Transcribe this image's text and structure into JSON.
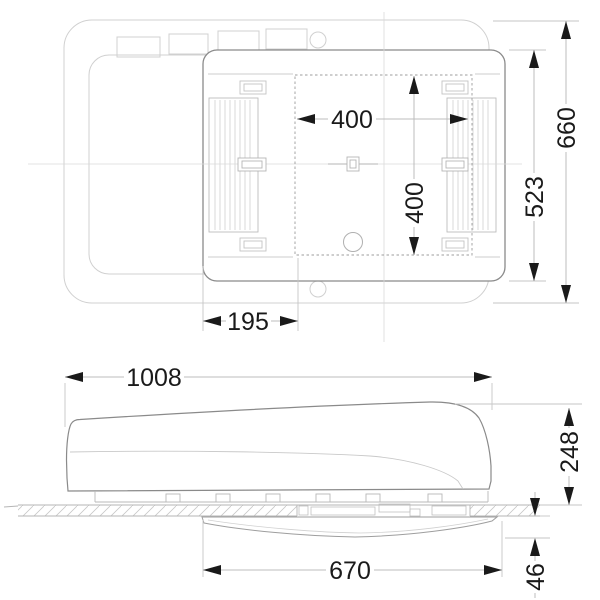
{
  "dimensions": {
    "top_view": {
      "cutout_width": "400",
      "cutout_length": "400",
      "edge_to_cutout": "195",
      "unit_width": "523",
      "overall_width": "660"
    },
    "side_view": {
      "overall_length": "1008",
      "height_above_roof": "248",
      "interior_unit_length": "670",
      "interior_unit_height": "46"
    }
  },
  "colors": {
    "ink": "#1a1a1a",
    "unit_outline": "#8a8a8a",
    "roof_outline": "#d0d0d0",
    "dimension_line": "#bcbcbc",
    "background": "#ffffff"
  }
}
